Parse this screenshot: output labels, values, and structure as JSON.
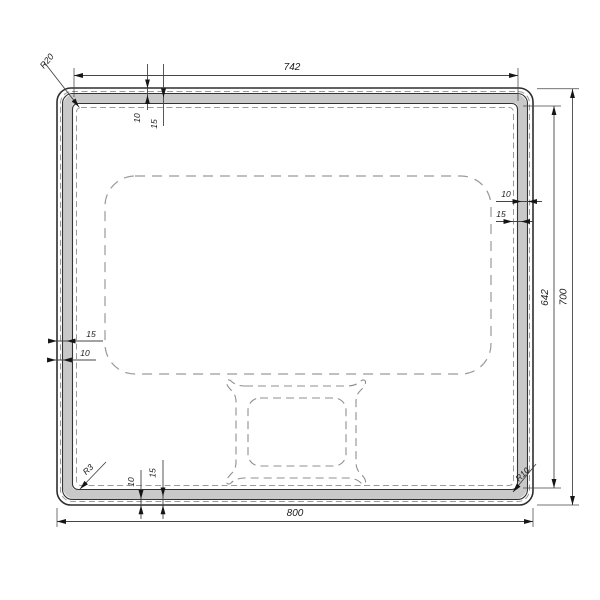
{
  "drawing": {
    "kind": "dimensioned technical drawing of rounded rectangular panel",
    "dimensions": {
      "outer_width": "800",
      "inner_width": "742",
      "outer_height": "700",
      "inner_height": "642",
      "edge_offset_small": "10",
      "edge_offset_large": "15",
      "radius_frame_corner": "R20",
      "radius_inner_bottom_left": "R3",
      "radius_inner_bottom_right": "R10"
    },
    "colors": {
      "background": "#ffffff",
      "outline": "#333333",
      "frame_fill": "#c9c9c9",
      "dashed_line": "#9a9a9a",
      "dimension_line": "#454545",
      "text": "#1c1c1c"
    }
  }
}
